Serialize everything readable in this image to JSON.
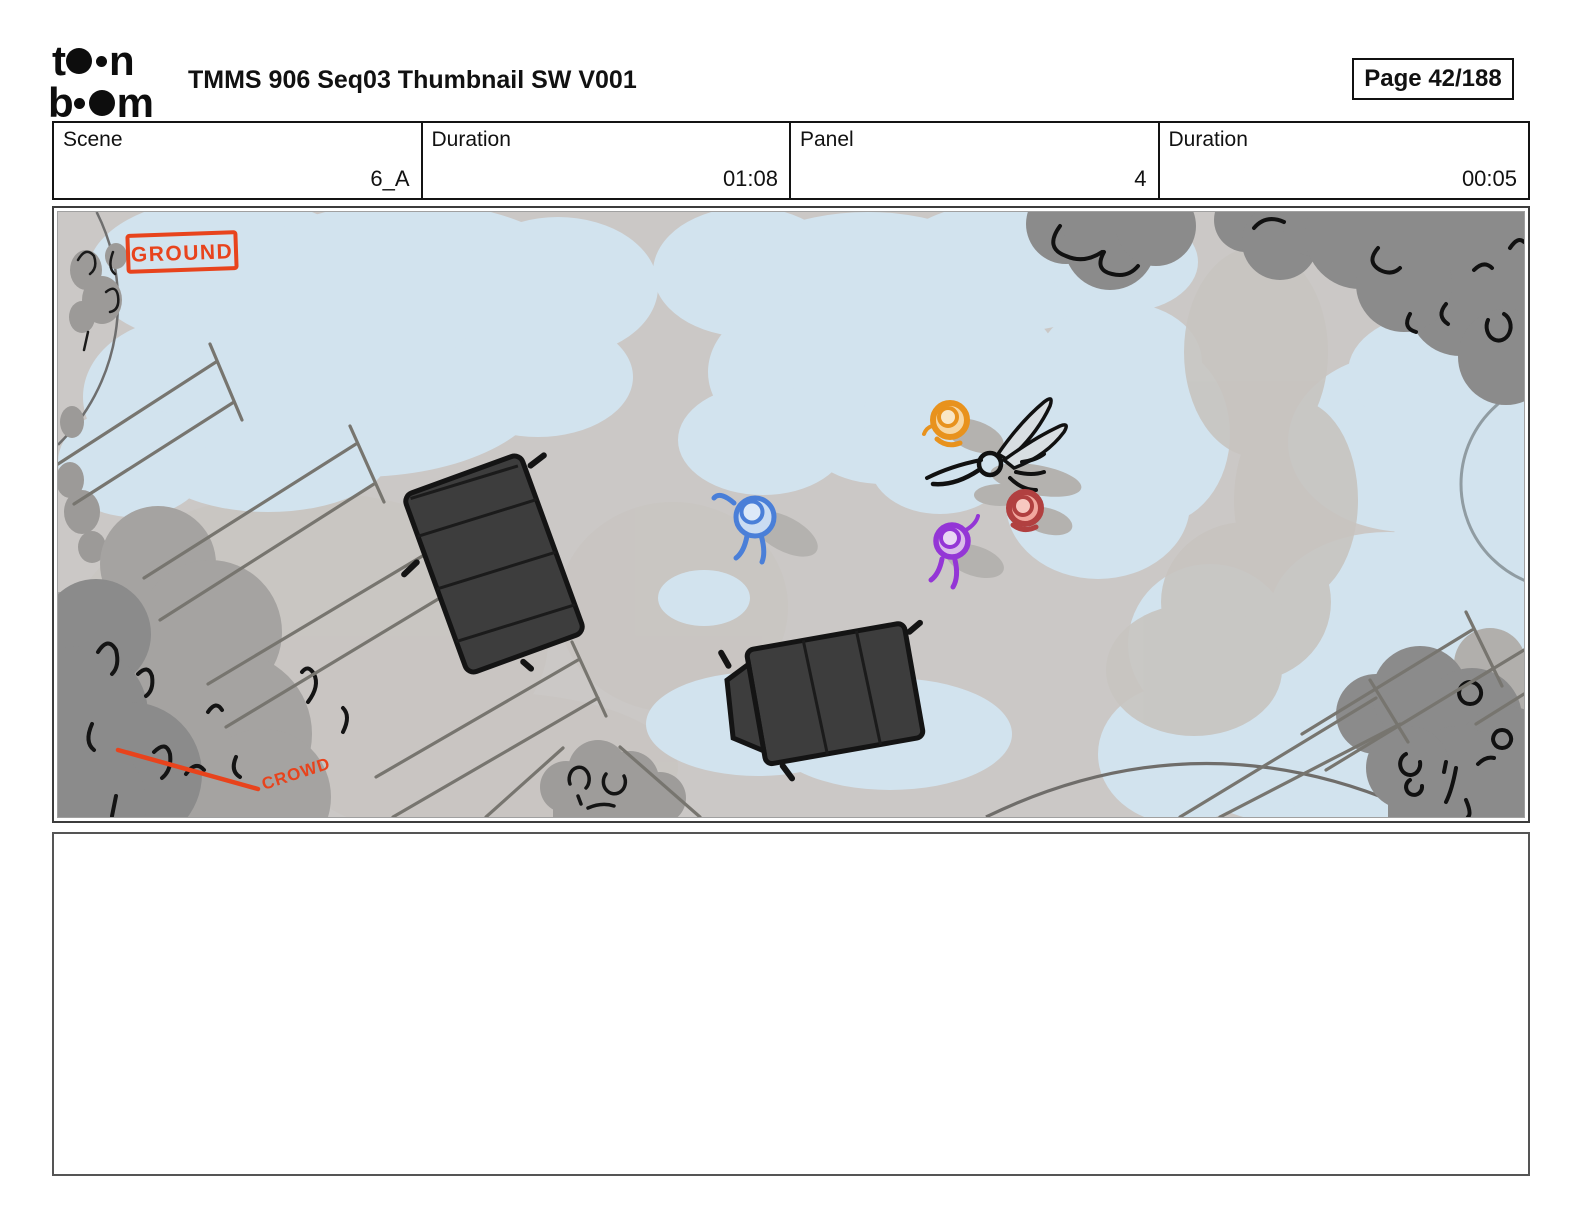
{
  "header": {
    "title": "TMMS 906 Seq03 Thumbnail SW V001",
    "page_label": "Page 42/188",
    "logo": {
      "l1a": "t",
      "l1b": "n",
      "l2a": "b",
      "l2b": "m"
    }
  },
  "info_table": {
    "cells": [
      {
        "label": "Scene",
        "value": "6_A"
      },
      {
        "label": "Duration",
        "value": "01:08"
      },
      {
        "label": "Panel",
        "value": "4"
      },
      {
        "label": "Duration",
        "value": "00:05"
      }
    ]
  },
  "panel": {
    "annotations": {
      "ground": "GROUND",
      "crowd": "CROWD"
    },
    "colors": {
      "annotation_red": "#e8431c",
      "ground": "#cbc8c6",
      "ground_shade": "#c8c4c0",
      "ice": "#d2e3ee",
      "canopy_dark": "#8b8b8b",
      "crowd_back": "#a5a3a1",
      "bush_gray": "#9e9c9a",
      "shadow_gray": "#b4b2af",
      "truck_fill": "#3d3d3d",
      "truck_line": "#141414",
      "char_blue": "#4a7fd8",
      "char_orange": "#e8921d",
      "char_red": "#b14040",
      "char_purple": "#9436d6"
    }
  },
  "caption": {
    "text": ""
  }
}
